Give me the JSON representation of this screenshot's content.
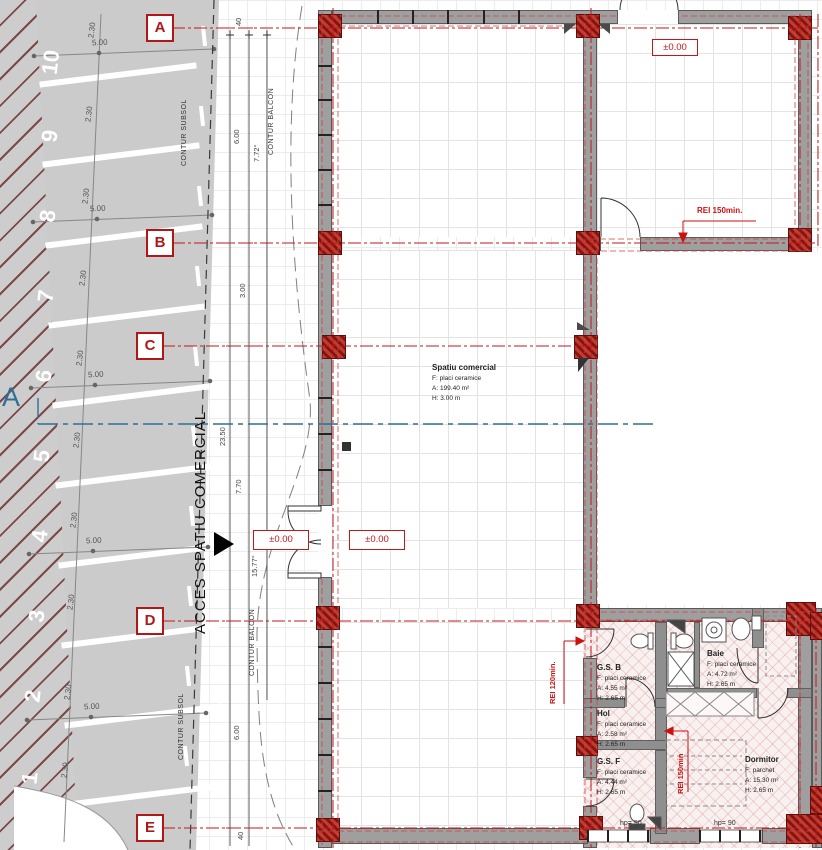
{
  "grid_bubbles": {
    "a": "A",
    "b": "B",
    "c": "C",
    "d": "D",
    "e": "E"
  },
  "section_marker": "A",
  "parking": {
    "numbers": [
      "10",
      "9",
      "8",
      "7",
      "6",
      "5",
      "4",
      "3",
      "2",
      "1"
    ],
    "width_dim": "2.30",
    "length_dim": "5.00"
  },
  "contours": {
    "subsol": "CONTUR SUBSOL",
    "balcon": "CONTUR BALCON"
  },
  "access_label": "ACCES SPATIU COMERCIAL",
  "dimensions": {
    "top_offset": "40",
    "span_top": "6.00",
    "angle_top": "7.72°",
    "span_b": "3.00",
    "total": "23.50",
    "span_mid": "7.70",
    "angle_mid": "15.77°",
    "span_bottom": "6.00",
    "bottom_offset": "40"
  },
  "levels": {
    "ground": "±0.00"
  },
  "fire_ratings": {
    "top": "REI 150min.",
    "mid": "REI 120min.",
    "bottom": "REI 150min"
  },
  "rooms": [
    {
      "name": "Spatiu comercial",
      "floor": "F: placi ceramice",
      "area": "A: 199.40 m²",
      "height": "H: 3.00 m"
    },
    {
      "name": "G.S. B",
      "floor": "F: placi ceramice",
      "area": "A: 4.55 m²",
      "height": "H: 2.65 m"
    },
    {
      "name": "Baie",
      "floor": "F: placi ceramice",
      "area": "A: 4.72 m²",
      "height": "H: 2.65 m"
    },
    {
      "name": "Hol",
      "floor": "F: placi ceramice",
      "area": "A: 2.58 m²",
      "height": "H: 2.65 m"
    },
    {
      "name": "G.S. F",
      "floor": "F: placi ceramice",
      "area": "A: 4.44 m²",
      "height": "H: 2.65 m"
    },
    {
      "name": "Dormitor",
      "floor": "F: parchet",
      "area": "A: 15.30 m²",
      "height": "H: 2.65 m"
    }
  ],
  "windows": {
    "parapet": "hp= 90"
  },
  "colors": {
    "accent_red": "#b01818",
    "wall_gray": "#9f9f9f",
    "parking_gray": "#cbcbcb",
    "section_blue": "#2e6f96",
    "floor_pink": "#f9f0f0"
  }
}
